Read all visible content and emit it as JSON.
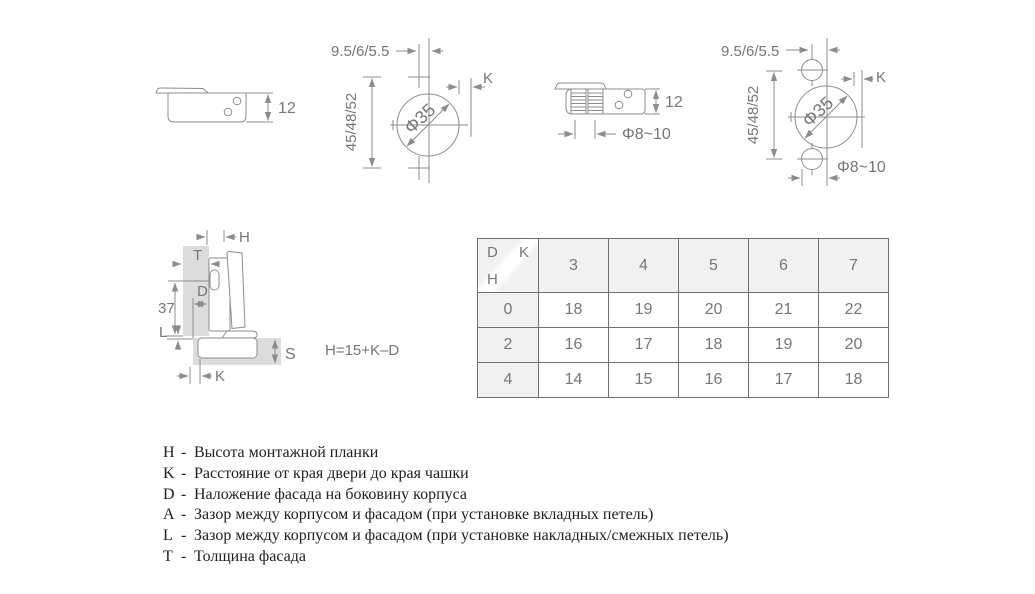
{
  "colors": {
    "line": "#8c8c8c",
    "dim_label": "#767676",
    "panel_gray": "#dcdcdc",
    "table_border": "#6f6f6f",
    "table_header_bg": "#f1f1f1",
    "legend_text": "#202020"
  },
  "diagrams": {
    "cup_side": {
      "height": "12"
    },
    "drill_screw_on": {
      "edge_distance": "9.5/6/5.5",
      "hole_spacing": "45/48/52",
      "cup_diameter": "Φ35",
      "k_label": "K"
    },
    "cup_side_dowel": {
      "height": "12",
      "dowel_diameter": "Φ8~10"
    },
    "drill_dowel": {
      "edge_distance": "9.5/6/5.5",
      "hole_spacing": "45/48/52",
      "cup_diameter": "Φ35",
      "k_label": "K",
      "dowel_diameter": "Φ8~10"
    },
    "cross_section": {
      "h": "H",
      "t": "T",
      "d": "D",
      "screw_line": "37",
      "l": "L",
      "s": "S",
      "k": "K",
      "formula": "H=15+K–D"
    }
  },
  "table": {
    "corner": {
      "col1": "D",
      "col2": "K",
      "row": "H"
    },
    "columns": [
      "3",
      "4",
      "5",
      "6",
      "7"
    ],
    "rows": [
      {
        "h": "0",
        "values": [
          "18",
          "19",
          "20",
          "21",
          "22"
        ]
      },
      {
        "h": "2",
        "values": [
          "16",
          "17",
          "18",
          "19",
          "20"
        ]
      },
      {
        "h": "4",
        "values": [
          "14",
          "15",
          "16",
          "17",
          "18"
        ]
      }
    ]
  },
  "legend": {
    "separator": "-",
    "items": [
      {
        "letter": "H",
        "desc": "Высота монтажной планки"
      },
      {
        "letter": "K",
        "desc": "Расстояние от края двери до края чашки"
      },
      {
        "letter": "D",
        "desc": "Наложение фасада на боковину корпуса"
      },
      {
        "letter": "A",
        "desc": "Зазор между корпусом и фасадом (при установке вкладных петель)"
      },
      {
        "letter": "L",
        "desc": "Зазор между корпусом и фасадом (при установке накладных/смежных петель)"
      },
      {
        "letter": "T",
        "desc": "Толщина фасада"
      }
    ]
  }
}
